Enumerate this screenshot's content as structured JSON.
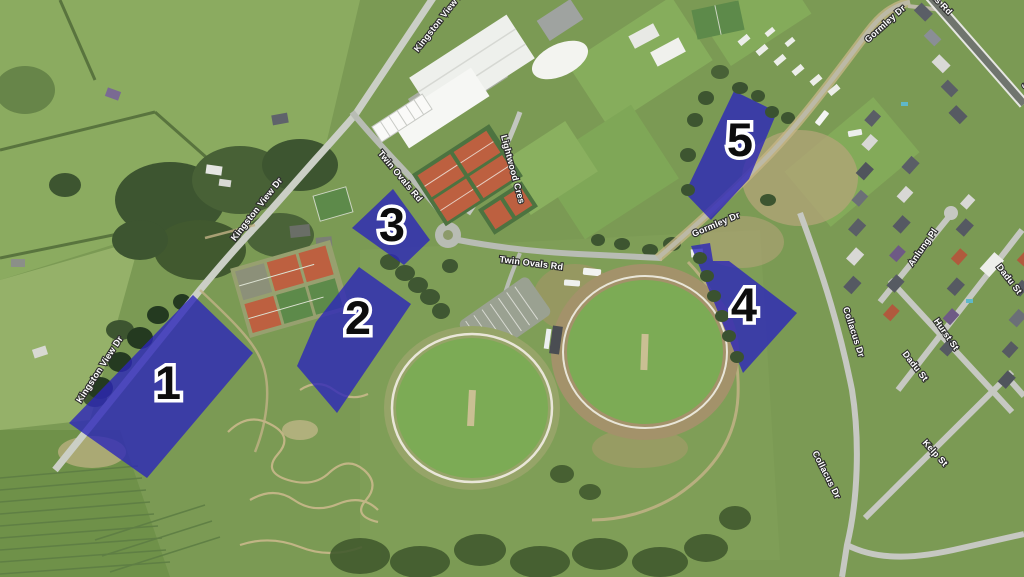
{
  "map": {
    "description": "Aerial satellite view of a sports precinct with five highlighted zones",
    "zone_fill_color": "#2c25b9",
    "zone_number_color": "#0d0d0d",
    "road_label_color": "#ffffff"
  },
  "zones": [
    {
      "number": "1"
    },
    {
      "number": "2"
    },
    {
      "number": "3"
    },
    {
      "number": "4"
    },
    {
      "number": "5"
    }
  ],
  "road_labels": {
    "kingston_view_dr_1": "Kingston View Dr",
    "kingston_view_dr_2": "Kingston View Dr",
    "kingston_view_dr_3": "Kingston View Dr",
    "twin_ovals_rd_1": "Twin Ovals Rd",
    "twin_ovals_rd_2": "Twin Ovals Rd",
    "lightwood_cres": "Lightwood Cres",
    "gormley_dr_1": "Gormley Dr",
    "gormley_dr_2": "Gormley Dr",
    "summerleas_rd_1": "Summerleas Rd",
    "summerleas_rd_2": "Summerleas Rd",
    "anlung_pl": "Anlung Pl",
    "dadu_st_1": "Dadu St",
    "dadu_st_2": "Dadu St",
    "hurst_st": "Hurst St",
    "collacus_dr_1": "Collacus Dr",
    "collacus_dr_2": "Collacus Dr",
    "kelp_st": "Kelp St"
  }
}
